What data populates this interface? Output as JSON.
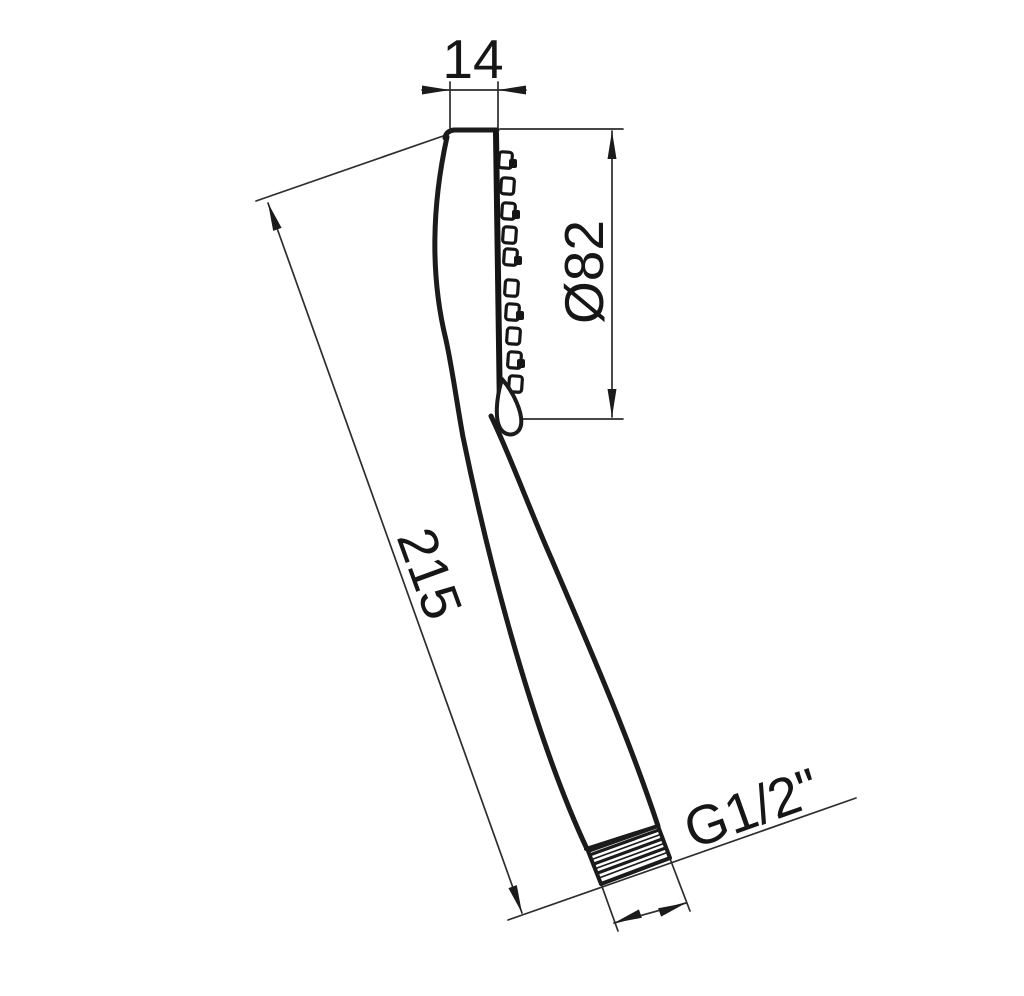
{
  "drawing": {
    "type": "technical-dimension-drawing",
    "subject": "hand shower head, side profile with threaded handle outlet",
    "background_color": "#ffffff",
    "line_color": "#1b1b1b",
    "dimension_line_color": "#2d2d2d",
    "dimensions": {
      "head_thickness": {
        "label": "14"
      },
      "head_diameter": {
        "label": "Ø82"
      },
      "overall_length": {
        "label": "215"
      },
      "connection_thread": {
        "label": "G1/2\""
      }
    }
  }
}
